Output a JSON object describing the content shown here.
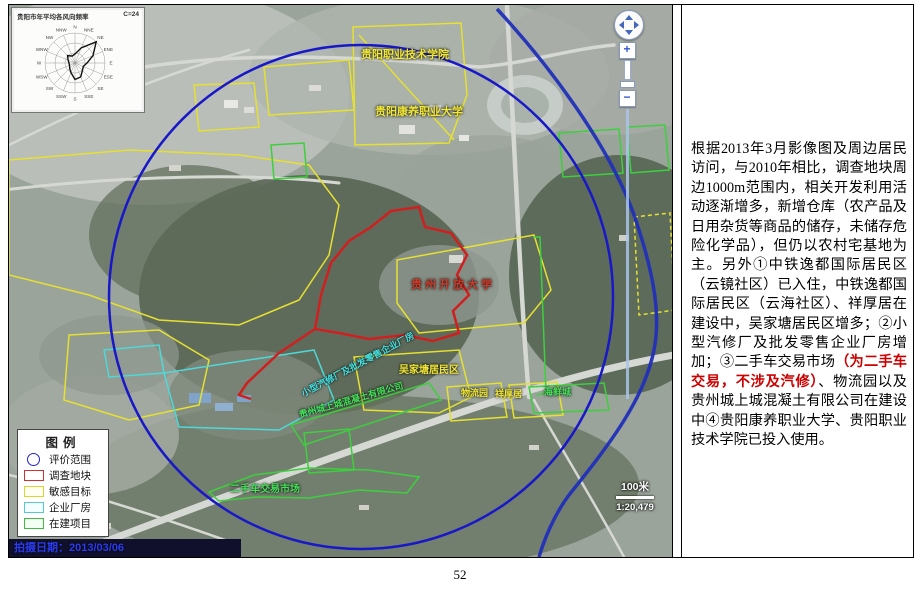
{
  "page": {
    "number": "52"
  },
  "windrose": {
    "title": "贵阳市年平均各风向频率",
    "calm_label": "C=24",
    "dirs": [
      "N",
      "NNE",
      "NE",
      "ENE",
      "E",
      "ESE",
      "SE",
      "SSE",
      "S",
      "SSW",
      "SW",
      "WSW",
      "W",
      "WNW",
      "NW",
      "NNW"
    ],
    "values": [
      0.3,
      0.55,
      1.0,
      0.65,
      0.4,
      0.3,
      0.35,
      0.5,
      0.55,
      0.35,
      0.25,
      0.2,
      0.2,
      0.25,
      0.35,
      0.25
    ]
  },
  "map": {
    "capture_date": "拍摄日期：2013/03/06",
    "scale": {
      "distance": "100米",
      "ratio": "1:20,479"
    },
    "nav": {
      "zoom_in": "+",
      "zoom_out": "−"
    },
    "labels": [
      {
        "text": "贵阳职业技术学院",
        "color": "yellow"
      },
      {
        "text": "贵阳康养职业大学",
        "color": "yellow"
      },
      {
        "text": "贵州开放大学",
        "color": "darkred"
      },
      {
        "text": "小型汽修厂及批发零售企业厂房",
        "color": "cyan"
      },
      {
        "text": "吴家塘居民区",
        "color": "yellow"
      },
      {
        "text": "贵州城上城混凝土有限公司",
        "color": "green"
      },
      {
        "text": "二手车交易市场",
        "color": "green"
      },
      {
        "text": "物流园",
        "color": "yellow"
      },
      {
        "text": "祥厚居",
        "color": "yellow"
      },
      {
        "text": "海鲜城",
        "color": "green"
      }
    ]
  },
  "legend": {
    "title": "图例",
    "items": [
      {
        "label": "评价范围",
        "color": "#2222cc",
        "symbol": "circle"
      },
      {
        "label": "调查地块",
        "color": "#cc3333",
        "symbol": "rect"
      },
      {
        "label": "敏感目标",
        "color": "#d8d830",
        "symbol": "rect"
      },
      {
        "label": "企业厂房",
        "color": "#55cccc",
        "symbol": "rect"
      },
      {
        "label": "在建项目",
        "color": "#44bb44",
        "symbol": "rect"
      }
    ]
  },
  "panel": {
    "text_parts": [
      {
        "text": "根据2013年3月影像图及周边居民访问，与2010年相比，调查地块周边1000m范围内，相关开发利用活动逐渐增多，新增仓库（农产品及日用杂货等商品的储存，未储存危险化学品），但仍以农村宅基地为主。另外①中铁逸都国际居民区（云镜社区）已入住，中铁逸都国际居民区（云海社区）、祥厚居在建设中，吴家塘居民区增多；②小型汽修厂及批发零售企业厂房增加；③二手车交易市场",
        "color": "#000000"
      },
      {
        "text": "（为二手车交易，不涉及汽修）",
        "color": "#cc0000"
      },
      {
        "text": "、物流园以及贵州城上城混凝土有限公司在建设中④贵阳康养职业大学、贵阳职业技术学院已投入使用。",
        "color": "#000000"
      }
    ]
  }
}
